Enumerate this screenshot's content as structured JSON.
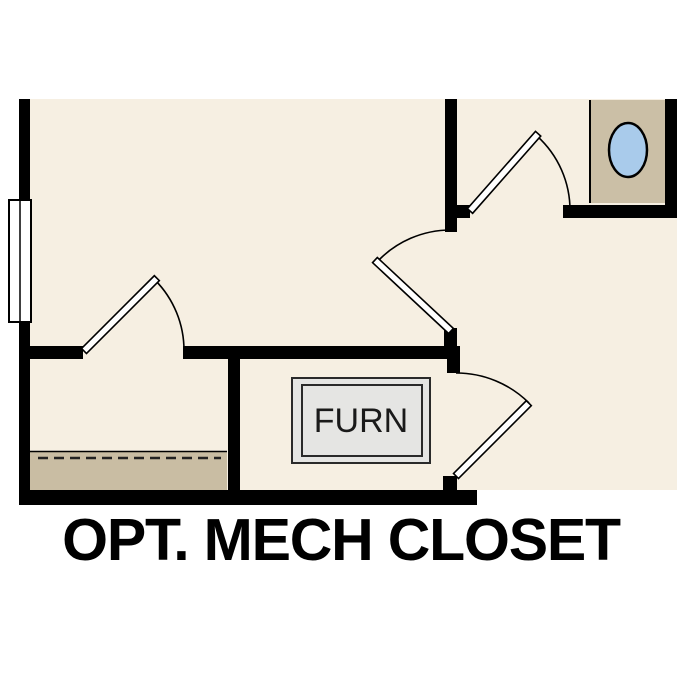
{
  "plan": {
    "label": "OPT. MECH CLOSET",
    "furnace_label": "FURN"
  },
  "theme": {
    "bg": "#ffffff",
    "floor": "#f6efe2",
    "wall": "#000000",
    "tan_room": "#cbbfa6",
    "stair": "#c9bda3",
    "fixture": "#a9cbeb",
    "furn_fill": "#e5e5e3",
    "line": "#1a1a1a"
  }
}
